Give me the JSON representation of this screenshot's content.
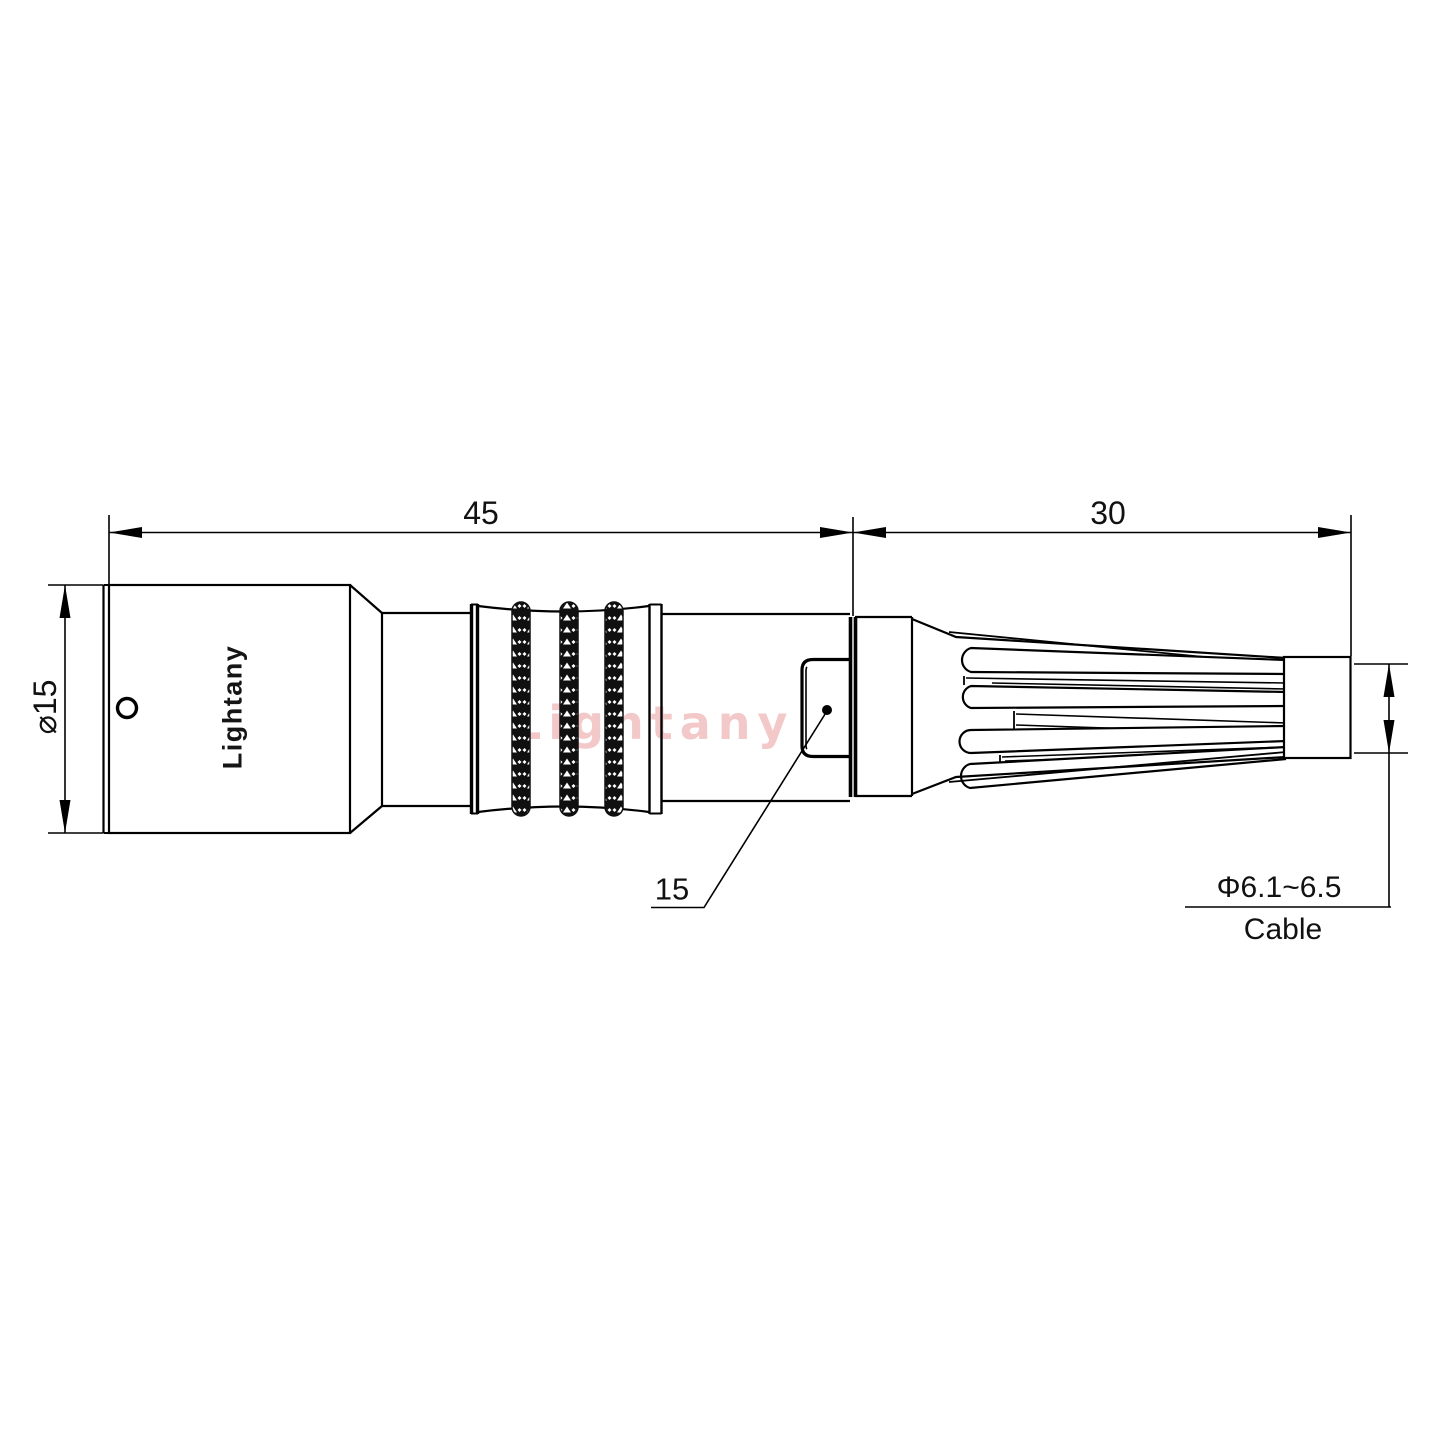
{
  "drawing": {
    "title_hint": "cable connector side-view technical drawing",
    "brand_label": "Lightany",
    "watermark": "Lightany",
    "dimensions": {
      "front_length": "45",
      "boot_length": "30",
      "body_diameter": "⌀15",
      "latch_length": "15",
      "cable_diameter": "Φ6.1~6.5",
      "cable_label": "Cable"
    },
    "colors": {
      "line": "#000000",
      "background": "#FFFFFF",
      "watermark_pink": "#E06E6E"
    }
  }
}
